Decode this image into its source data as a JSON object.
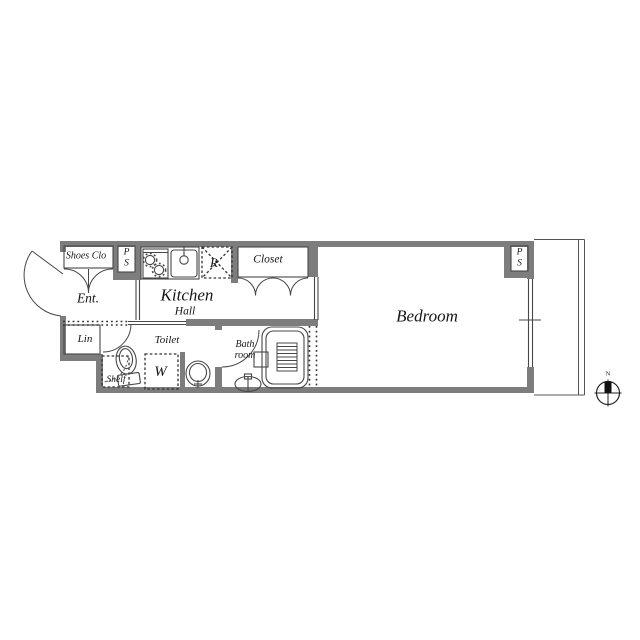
{
  "type": "apartment-floor-plan",
  "colors": {
    "background": "#ffffff",
    "wall": "#7d7d7d",
    "line": "#474747",
    "dark_line": "#222222",
    "text": "#161616"
  },
  "rooms": {
    "shoes_closet": {
      "label": "Shoes Clo"
    },
    "pipe_shaft_left": {
      "label": "PS"
    },
    "entrance": {
      "label": "Ent."
    },
    "kitchen": {
      "label": "Kitchen"
    },
    "hall": {
      "label": "Hall"
    },
    "refrigerator_space": {
      "label": "R"
    },
    "closet": {
      "label": "Closet"
    },
    "bedroom": {
      "label": "Bedroom"
    },
    "pipe_shaft_right": {
      "label": "PS"
    },
    "linen": {
      "label": "Lin"
    },
    "toilet": {
      "label": "Toilet"
    },
    "washer_space": {
      "label": "W"
    },
    "shelf": {
      "label": "Shelf"
    },
    "bathroom": {
      "label": "Bath room"
    }
  },
  "compass": {
    "north_label": "N"
  },
  "icons": {
    "stove": "stove-icon",
    "sink": "kitchen-sink-icon",
    "toilet": "toilet-icon",
    "washbasin": "washbasin-icon",
    "bathtub": "bathtub-icon",
    "bath_sink": "bath-sink-icon",
    "compass": "compass-icon",
    "doors": "door-swing-arc"
  }
}
